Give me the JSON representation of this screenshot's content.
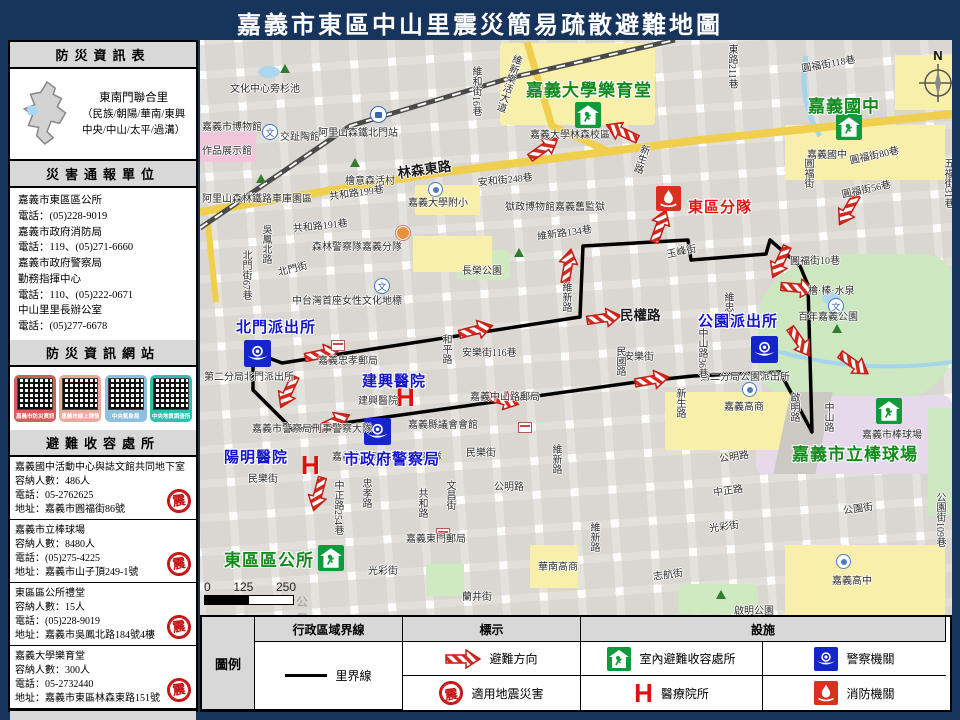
{
  "title": "嘉義市東區中山里震災簡易疏散避難地圖",
  "sidebar": {
    "info_header": "防災資訊表",
    "district": {
      "name": "東南門聯合里",
      "detail1": "（民族/朝陽/華南/東興",
      "detail2": "中央/中山/太平/過溝）"
    },
    "report_header": "災害通報單位",
    "contacts": [
      "嘉義市東區區公所",
      "電話：(05)228-9019",
      "嘉義市政府消防局",
      "電話：119、(05)271-6660",
      "嘉義市政府警察局",
      "勤務指揮中心",
      "電話：110、(05)222-0671",
      "中山里里長辦公室",
      "電話：(05)277-6678"
    ],
    "web_header": "防災資訊網站",
    "qr_sites": [
      {
        "label": "嘉義市防災資訊網",
        "color": "#d95b5b"
      },
      {
        "label": "嘉義市線上陳情",
        "color": "#eda89e"
      },
      {
        "label": "中央氣象局",
        "color": "#8fbede"
      },
      {
        "label": "中央地質調查所",
        "color": "#2fbfae"
      }
    ],
    "shelter_header": "避難收容處所",
    "shelters": [
      {
        "name": "嘉義國中活動中心與誌文館共同地下室",
        "capacity": "容納人數：486人",
        "phone": "電話：05-2762625",
        "addr": "地址：嘉義市圓福街86號"
      },
      {
        "name": "嘉義市立棒球場",
        "capacity": "容納人數：8480人",
        "phone": "電話：(05)275-4225",
        "addr": "地址：嘉義市山子頂249-1號"
      },
      {
        "name": "東區區公所禮堂",
        "capacity": "容納人數：15人",
        "phone": "電話：(05)228-9019",
        "addr": "地址：嘉義市吳鳳北路184號4樓"
      },
      {
        "name": "嘉義大學樂育堂",
        "capacity": "容納人數：300人",
        "phone": "電話：05-2732440",
        "addr": "地址：嘉義市東區林森東路151號"
      }
    ],
    "seal_char": "震",
    "footer": "東區區公所111年7月製作"
  },
  "legend": {
    "title": "圖例",
    "col1": "行政區域界線",
    "col2": "標示",
    "col3": "設施",
    "boundary_label": "里界線",
    "evac": "避難方向",
    "quake": "適用地震災害",
    "shelter": "室內避難收容處所",
    "hospital": "醫療院所",
    "police": "警察機關",
    "fire": "消防機關"
  },
  "map": {
    "compass": "N",
    "hospital_symbol": "H",
    "culture_glyph": "文",
    "scale": {
      "t0": "0",
      "t1": "125",
      "t2": "250",
      "unit": "公尺"
    },
    "street_labels": [
      {
        "t": "文化中心旁杉池",
        "x": 30,
        "y": 40
      },
      {
        "t": "嘉義市博物館",
        "x": 2,
        "y": 78
      },
      {
        "t": "交趾陶館",
        "x": 80,
        "y": 88
      },
      {
        "t": "阿里山森鐵北門站",
        "x": 118,
        "y": 84
      },
      {
        "t": "作品展示館",
        "x": 2,
        "y": 102
      },
      {
        "t": "阿里山森林鐵路車庫園區",
        "x": 2,
        "y": 150
      },
      {
        "t": "檜意森活村",
        "x": 145,
        "y": 132
      },
      {
        "t": "共和路199巷",
        "x": 128,
        "y": 148,
        "r": -8
      },
      {
        "t": "林森東路",
        "x": 196,
        "y": 122,
        "r": -8,
        "big": 1
      },
      {
        "t": "嘉義大學附小",
        "x": 208,
        "y": 154
      },
      {
        "t": "安和街248巷",
        "x": 277,
        "y": 134,
        "r": -6
      },
      {
        "t": "獄政博物館嘉義舊監獄",
        "x": 305,
        "y": 158
      },
      {
        "t": "嘉義大學林森校區",
        "x": 330,
        "y": 86
      },
      {
        "t": "圓福街118巷",
        "x": 600,
        "y": 20,
        "r": -10
      },
      {
        "t": "嘉義國中",
        "x": 607,
        "y": 106
      },
      {
        "t": "圓福街80巷",
        "x": 648,
        "y": 112,
        "r": -12
      },
      {
        "t": "圓福街56巷",
        "x": 640,
        "y": 146,
        "r": -12
      },
      {
        "t": "共和路191巷",
        "x": 92,
        "y": 180,
        "r": -6
      },
      {
        "t": "森林警察隊嘉義分隊",
        "x": 112,
        "y": 198
      },
      {
        "t": "長榮公園",
        "x": 262,
        "y": 222
      },
      {
        "t": "維新路134巷",
        "x": 336,
        "y": 188,
        "r": -8
      },
      {
        "t": "中台灣首座女性文化地標",
        "x": 92,
        "y": 252
      },
      {
        "t": "玉峰街",
        "x": 465,
        "y": 206,
        "r": -12
      },
      {
        "t": "圓福街10巷",
        "x": 590,
        "y": 212
      },
      {
        "t": "檜·棒·水泉",
        "x": 608,
        "y": 242
      },
      {
        "t": "百年嘉義公園",
        "x": 598,
        "y": 268
      },
      {
        "t": "第二分局北門派出所",
        "x": 4,
        "y": 328
      },
      {
        "t": "嘉義忠孝郵局",
        "x": 118,
        "y": 312
      },
      {
        "t": "安樂街116巷",
        "x": 262,
        "y": 304
      },
      {
        "t": "民權路",
        "x": 420,
        "y": 264,
        "big": 1
      },
      {
        "t": "安樂街",
        "x": 424,
        "y": 308
      },
      {
        "t": "第二分局公園派出所",
        "x": 500,
        "y": 328
      },
      {
        "t": "嘉義中山路郵局",
        "x": 270,
        "y": 348
      },
      {
        "t": "嘉義縣議會會館",
        "x": 208,
        "y": 376
      },
      {
        "t": "嘉義市警察局刑事警察大隊",
        "x": 52,
        "y": 380
      },
      {
        "t": "建興醫院",
        "x": 158,
        "y": 352
      },
      {
        "t": "嘉義市警察局保安警察隊",
        "x": 132,
        "y": 408
      },
      {
        "t": "民樂街",
        "x": 48,
        "y": 430
      },
      {
        "t": "民樂街",
        "x": 266,
        "y": 404
      },
      {
        "t": "公明路",
        "x": 294,
        "y": 438
      },
      {
        "t": "嘉義東門郵局",
        "x": 206,
        "y": 490
      },
      {
        "t": "光彩街",
        "x": 168,
        "y": 522
      },
      {
        "t": "蘭井街",
        "x": 262,
        "y": 548
      },
      {
        "t": "華南高商",
        "x": 338,
        "y": 518
      },
      {
        "t": "嘉義高商",
        "x": 524,
        "y": 358
      },
      {
        "t": "公明路",
        "x": 518,
        "y": 410,
        "r": -8
      },
      {
        "t": "中正路",
        "x": 512,
        "y": 444,
        "r": -8
      },
      {
        "t": "光彩街",
        "x": 508,
        "y": 480,
        "r": -8
      },
      {
        "t": "志航街",
        "x": 452,
        "y": 528,
        "r": -8
      },
      {
        "t": "公園街",
        "x": 642,
        "y": 462,
        "r": -8
      },
      {
        "t": "嘉義市棒球場",
        "x": 662,
        "y": 386
      },
      {
        "t": "嘉義高中",
        "x": 632,
        "y": 532
      },
      {
        "t": "啟明公園",
        "x": 534,
        "y": 562
      },
      {
        "t": "維和街16巷",
        "x": 268,
        "y": 26,
        "v": 1
      },
      {
        "t": "維新樂活大道",
        "x": 310,
        "y": 12,
        "v": 1,
        "r": 18
      },
      {
        "t": "東路211巷",
        "x": 524,
        "y": 4,
        "v": 1
      },
      {
        "t": "新生路",
        "x": 438,
        "y": 102,
        "v": 1,
        "r": 18
      },
      {
        "t": "圓福街",
        "x": 600,
        "y": 118,
        "v": 1
      },
      {
        "t": "五福街31巷",
        "x": 740,
        "y": 118,
        "v": 1
      },
      {
        "t": "吳鳳北路",
        "x": 58,
        "y": 184,
        "v": 1
      },
      {
        "t": "北門街67巷",
        "x": 38,
        "y": 210,
        "v": 1
      },
      {
        "t": "北門街",
        "x": 76,
        "y": 224,
        "r": -14
      },
      {
        "t": "維新路",
        "x": 358,
        "y": 242,
        "v": 1
      },
      {
        "t": "維忠街",
        "x": 520,
        "y": 252,
        "v": 1
      },
      {
        "t": "中山路36巷",
        "x": 494,
        "y": 288,
        "v": 1
      },
      {
        "t": "民國路",
        "x": 412,
        "y": 306,
        "v": 1
      },
      {
        "t": "和平路",
        "x": 238,
        "y": 294,
        "v": 1
      },
      {
        "t": "新生路",
        "x": 472,
        "y": 348,
        "v": 1
      },
      {
        "t": "啟明路",
        "x": 586,
        "y": 352,
        "v": 1
      },
      {
        "t": "中山路",
        "x": 620,
        "y": 362,
        "v": 1
      },
      {
        "t": "忠孝路",
        "x": 158,
        "y": 438,
        "v": 1
      },
      {
        "t": "中正路254巷",
        "x": 130,
        "y": 440,
        "v": 1
      },
      {
        "t": "共和路",
        "x": 214,
        "y": 448,
        "v": 1
      },
      {
        "t": "文昌街",
        "x": 242,
        "y": 440,
        "v": 1
      },
      {
        "t": "維新路",
        "x": 348,
        "y": 404,
        "v": 1
      },
      {
        "t": "維新路",
        "x": 386,
        "y": 482,
        "v": 1
      },
      {
        "t": "公園街109巷",
        "x": 732,
        "y": 452,
        "v": 1
      }
    ],
    "poi_labels": [
      {
        "t": "嘉義大學樂育堂",
        "x": 326,
        "y": 36,
        "k": "green"
      },
      {
        "t": "嘉義國中",
        "x": 608,
        "y": 52,
        "k": "green"
      },
      {
        "t": "嘉義市立棒球場",
        "x": 592,
        "y": 400,
        "k": "green"
      },
      {
        "t": "東區區公所",
        "x": 24,
        "y": 506,
        "k": "green"
      },
      {
        "t": "北門派出所",
        "x": 36,
        "y": 276,
        "k": "blue"
      },
      {
        "t": "公園派出所",
        "x": 498,
        "y": 270,
        "k": "blue"
      },
      {
        "t": "市政府警察局",
        "x": 144,
        "y": 408,
        "k": "blue"
      },
      {
        "t": "建興醫院",
        "x": 162,
        "y": 330,
        "k": "blue"
      },
      {
        "t": "陽明醫院",
        "x": 24,
        "y": 406,
        "k": "blue"
      },
      {
        "t": "東區分隊",
        "x": 488,
        "y": 156,
        "k": "red"
      }
    ],
    "icons": [
      {
        "k": "shelter",
        "x": 375,
        "y": 62
      },
      {
        "k": "shelter",
        "x": 636,
        "y": 74
      },
      {
        "k": "shelter",
        "x": 676,
        "y": 358
      },
      {
        "k": "shelter",
        "x": 118,
        "y": 505
      },
      {
        "k": "police",
        "x": 44,
        "y": 300
      },
      {
        "k": "police",
        "x": 551,
        "y": 296
      },
      {
        "k": "police",
        "x": 164,
        "y": 378
      },
      {
        "k": "fire",
        "x": 456,
        "y": 146
      },
      {
        "k": "hosp",
        "x": 196,
        "y": 344
      },
      {
        "k": "hosp",
        "x": 101,
        "y": 412
      },
      {
        "k": "wen",
        "x": 62,
        "y": 84
      },
      {
        "k": "wen",
        "x": 174,
        "y": 238
      },
      {
        "k": "wen",
        "x": 628,
        "y": 258
      },
      {
        "k": "train",
        "x": 170,
        "y": 66
      },
      {
        "k": "school",
        "x": 228,
        "y": 142
      },
      {
        "k": "school",
        "x": 542,
        "y": 342
      },
      {
        "k": "school",
        "x": 636,
        "y": 514
      },
      {
        "k": "orange",
        "x": 196,
        "y": 186
      },
      {
        "k": "post",
        "x": 131,
        "y": 300
      },
      {
        "k": "post",
        "x": 236,
        "y": 477
      },
      {
        "k": "post",
        "x": 318,
        "y": 360
      },
      {
        "k": "tree",
        "x": 80,
        "y": 24
      },
      {
        "k": "tree",
        "x": 56,
        "y": 134
      },
      {
        "k": "tree",
        "x": 150,
        "y": 118
      },
      {
        "k": "tree",
        "x": 314,
        "y": 208
      },
      {
        "k": "tree",
        "x": 632,
        "y": 284
      },
      {
        "k": "tree",
        "x": 516,
        "y": 550
      }
    ],
    "arrows": [
      {
        "x": 404,
        "y": 82,
        "r": 205
      },
      {
        "x": 326,
        "y": 98,
        "r": -35
      },
      {
        "x": 442,
        "y": 176,
        "r": -70
      },
      {
        "x": 562,
        "y": 212,
        "r": 115
      },
      {
        "x": 580,
        "y": 238,
        "r": 5
      },
      {
        "x": 582,
        "y": 292,
        "r": 55
      },
      {
        "x": 630,
        "y": 160,
        "r": 120
      },
      {
        "x": 636,
        "y": 314,
        "r": 35
      },
      {
        "x": 386,
        "y": 268,
        "r": -8
      },
      {
        "x": 258,
        "y": 280,
        "r": -15
      },
      {
        "x": 104,
        "y": 304,
        "r": -12
      },
      {
        "x": 70,
        "y": 342,
        "r": 115
      },
      {
        "x": 116,
        "y": 372,
        "r": -25
      },
      {
        "x": 284,
        "y": 350,
        "r": 15
      },
      {
        "x": 100,
        "y": 444,
        "r": 105
      },
      {
        "x": 434,
        "y": 330,
        "r": -10
      },
      {
        "x": 350,
        "y": 216,
        "r": -80
      }
    ]
  }
}
